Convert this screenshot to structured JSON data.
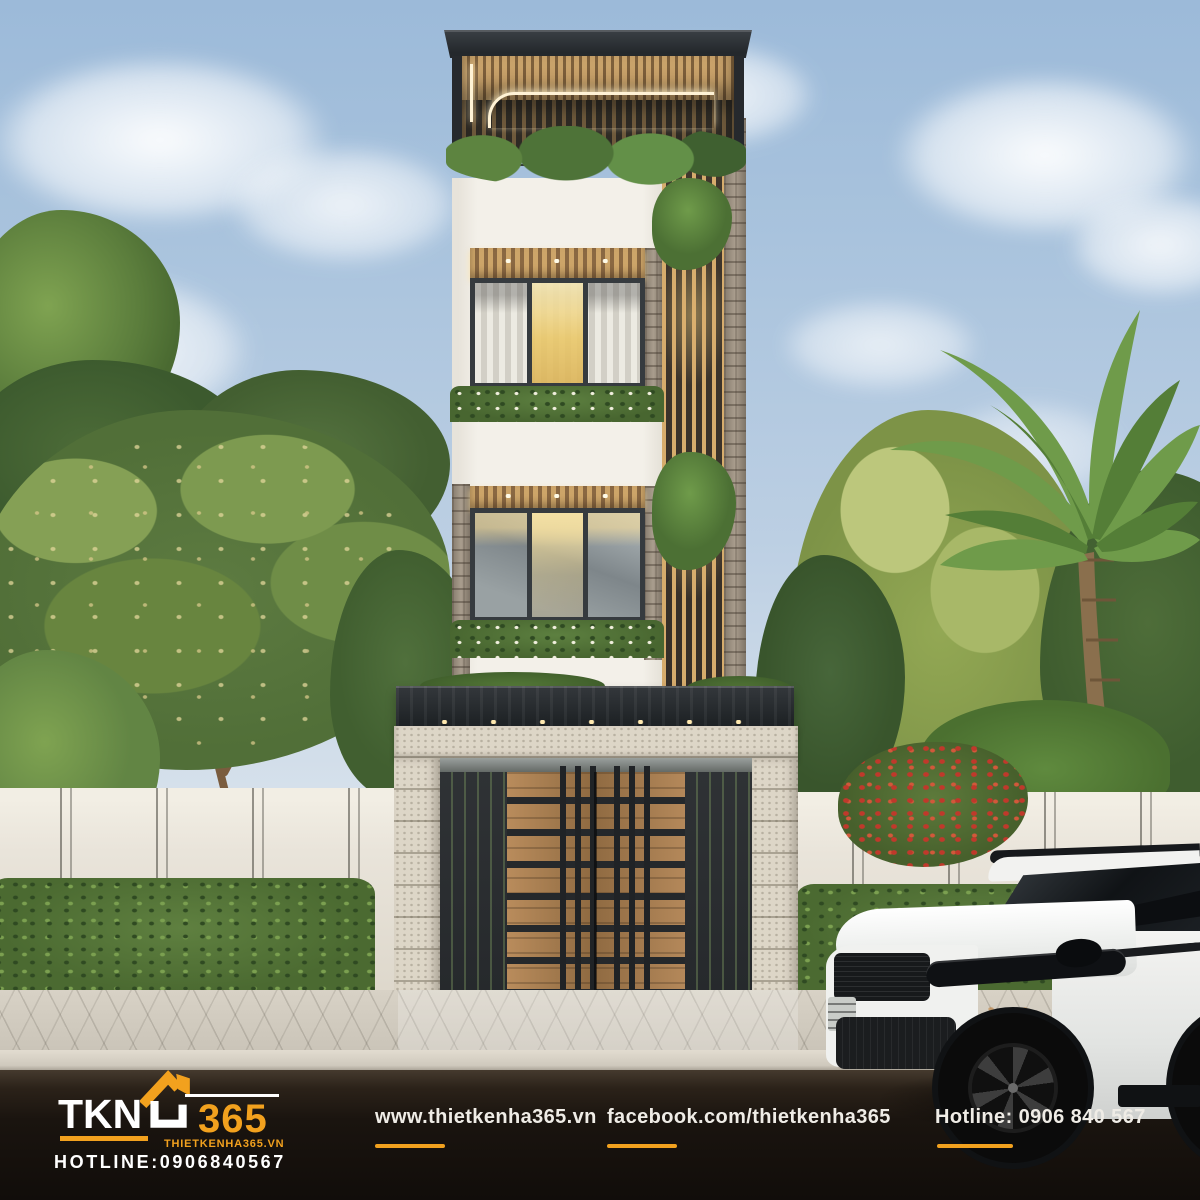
{
  "branding": {
    "logo": {
      "name": "TKN",
      "number": "365",
      "website": "THIETKENHA365.VN",
      "hotline": "HOTLINE:0906840567"
    },
    "footer": {
      "website": "www.thietkenha365.vn",
      "facebook": "facebook.com/thietkenha365",
      "hotline": "Hotline: 0906 840 567"
    }
  },
  "colors": {
    "accent_orange": "#F2A11E",
    "sky_blue": "#A9C3DD",
    "wall_white": "#F3F0E9",
    "wood": "#B08A57",
    "roof_dark": "#2A2E32",
    "fence_cream": "#E9E4DA",
    "foliage": "#5F7F3F",
    "road_dark": "#17120E",
    "car_white": "#F4F4F2"
  }
}
